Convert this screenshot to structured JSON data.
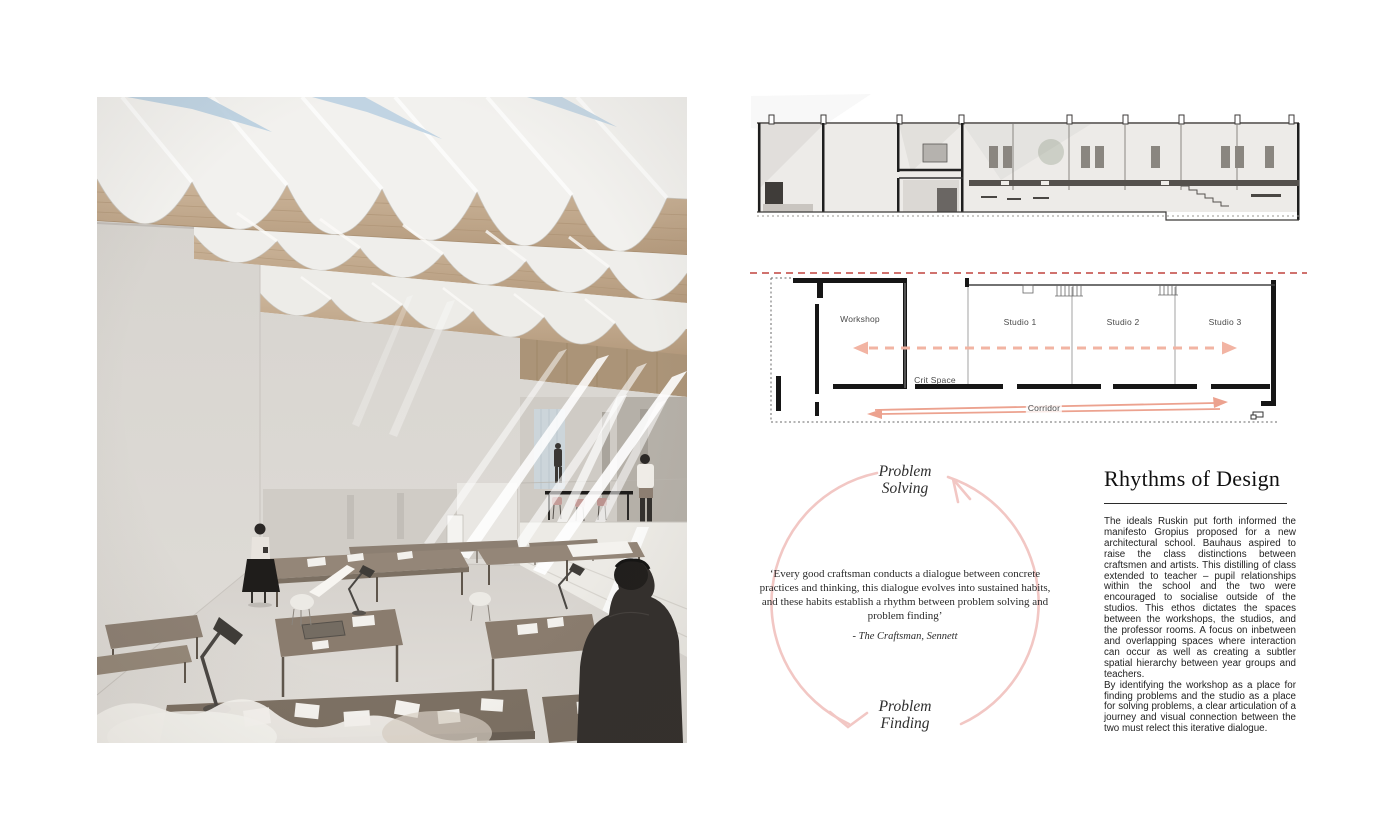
{
  "page": {
    "background": "#ffffff"
  },
  "colors": {
    "cycle_arrow": "#f2c7c4",
    "plan_arrow_dashed": "#f2b4a3",
    "plan_arrow_solid": "#eca28f",
    "section_cut_line": "#c0443f",
    "wood": "#c4ad92",
    "plan_wall": "#161616"
  },
  "plan": {
    "labels": {
      "workshop": "Workshop",
      "studio_1": "Studio 1",
      "studio_2": "Studio 2",
      "studio_3": "Studio 3",
      "crit_space": "Crit Space",
      "corridor": "Corridor"
    }
  },
  "cycle": {
    "top_label": "Problem\nSolving",
    "bottom_label": "Problem\nFinding",
    "quote": "‘Every good craftsman conducts a dialogue between concrete practices and thinking, this dialogue evolves into sustained habits, and these habits establish a rhythm between problem solving and problem finding’",
    "attribution": "- The Craftsman, Sennett"
  },
  "article": {
    "title": "Rhythms of Design",
    "paragraphs": [
      "The ideals Ruskin put forth informed the manifesto Gropius proposed for a new architectural school. Bauhaus aspired to raise the class distinctions between craftsmen and artists. This distilling of class extended to teacher – pupil relationships within the school and the two were encouraged to socialise outside of the studios. This ethos dictates the spaces between the workshops, the studios, and the professor rooms. A focus on inbetween and overlapping spaces where interaction can occur as well as creating a subtler spatial hierarchy between year groups and teachers.",
      "By identifying the workshop as a place for finding problems and the studio as a place for solving problems, a clear articulation of a journey and visual connection between the two must relect this iterative dialogue."
    ]
  }
}
